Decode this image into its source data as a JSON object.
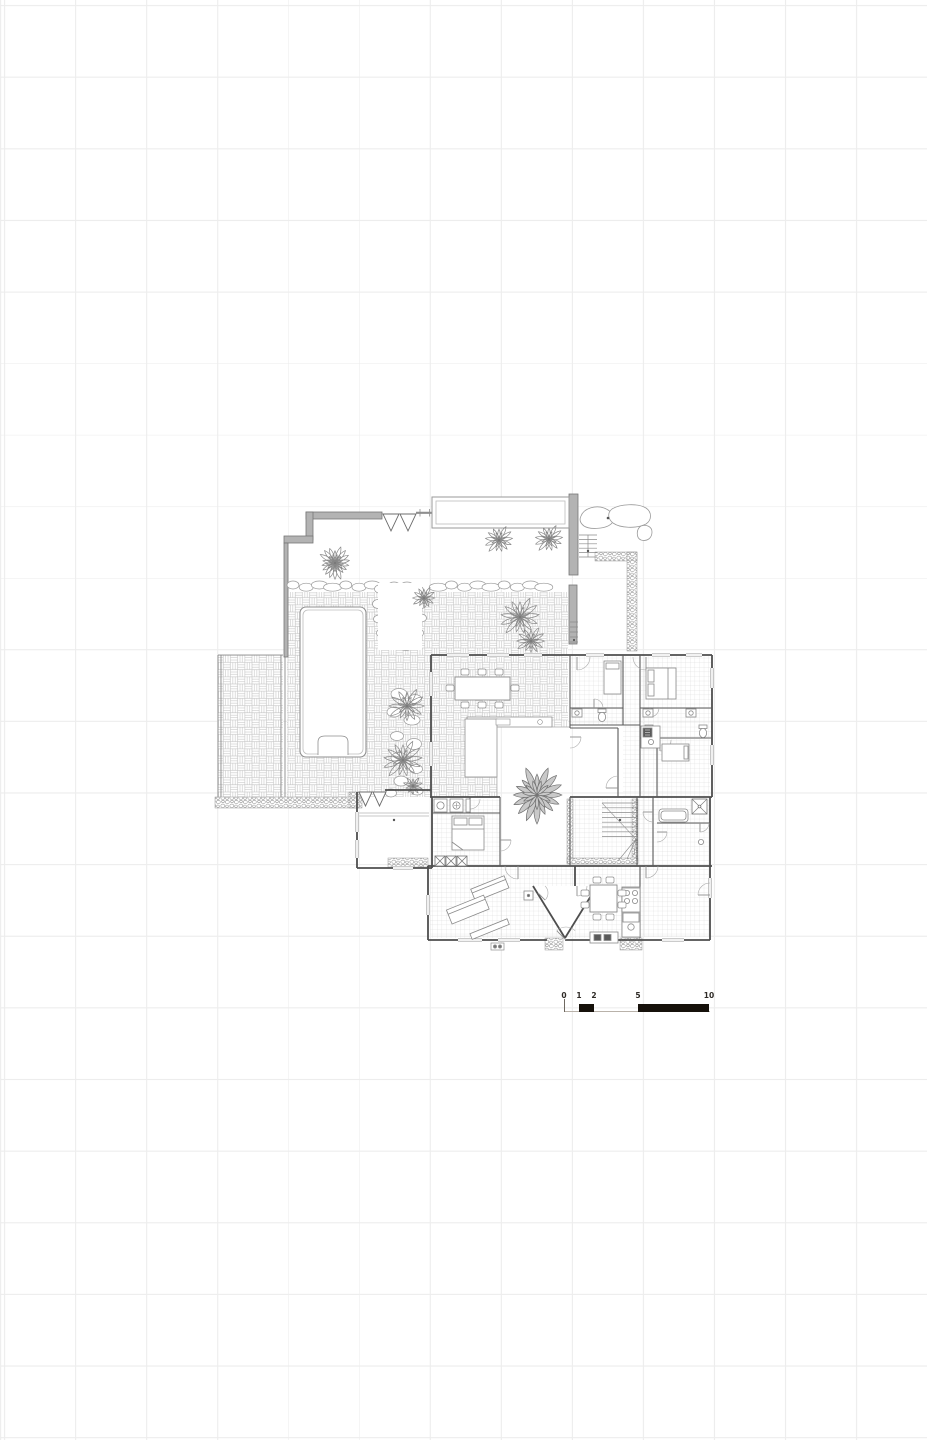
{
  "page": {
    "background": "#ffffff",
    "grid": {
      "color": "#ededed",
      "spacing_x_px": 71,
      "spacing_y_px": 71.6,
      "offset_x": 4,
      "offset_y": 5
    }
  },
  "drawing": {
    "kind": "architectural site / floor plan, grayscale line drawing",
    "colors": {
      "wall_ink": "#4e4e4e",
      "light_ink": "#8f8f8f",
      "paving_pattern": "#c3c3c3",
      "tile_pattern": "#d4d4d4",
      "pebble": "#9a9a9a",
      "thick_wall_fill": "#b3b3b3",
      "plant": "#878787",
      "courtyard_plant_fill": "#c9c9c9"
    }
  },
  "scale_bar": {
    "labels": [
      "0",
      "1",
      "2",
      "5",
      "10"
    ],
    "values_m": [
      0,
      1,
      2,
      5,
      10
    ],
    "label_positions_px": [
      564,
      579,
      594,
      638,
      709
    ],
    "bar_color": "#16110b",
    "label_color": "#2e2a26"
  }
}
